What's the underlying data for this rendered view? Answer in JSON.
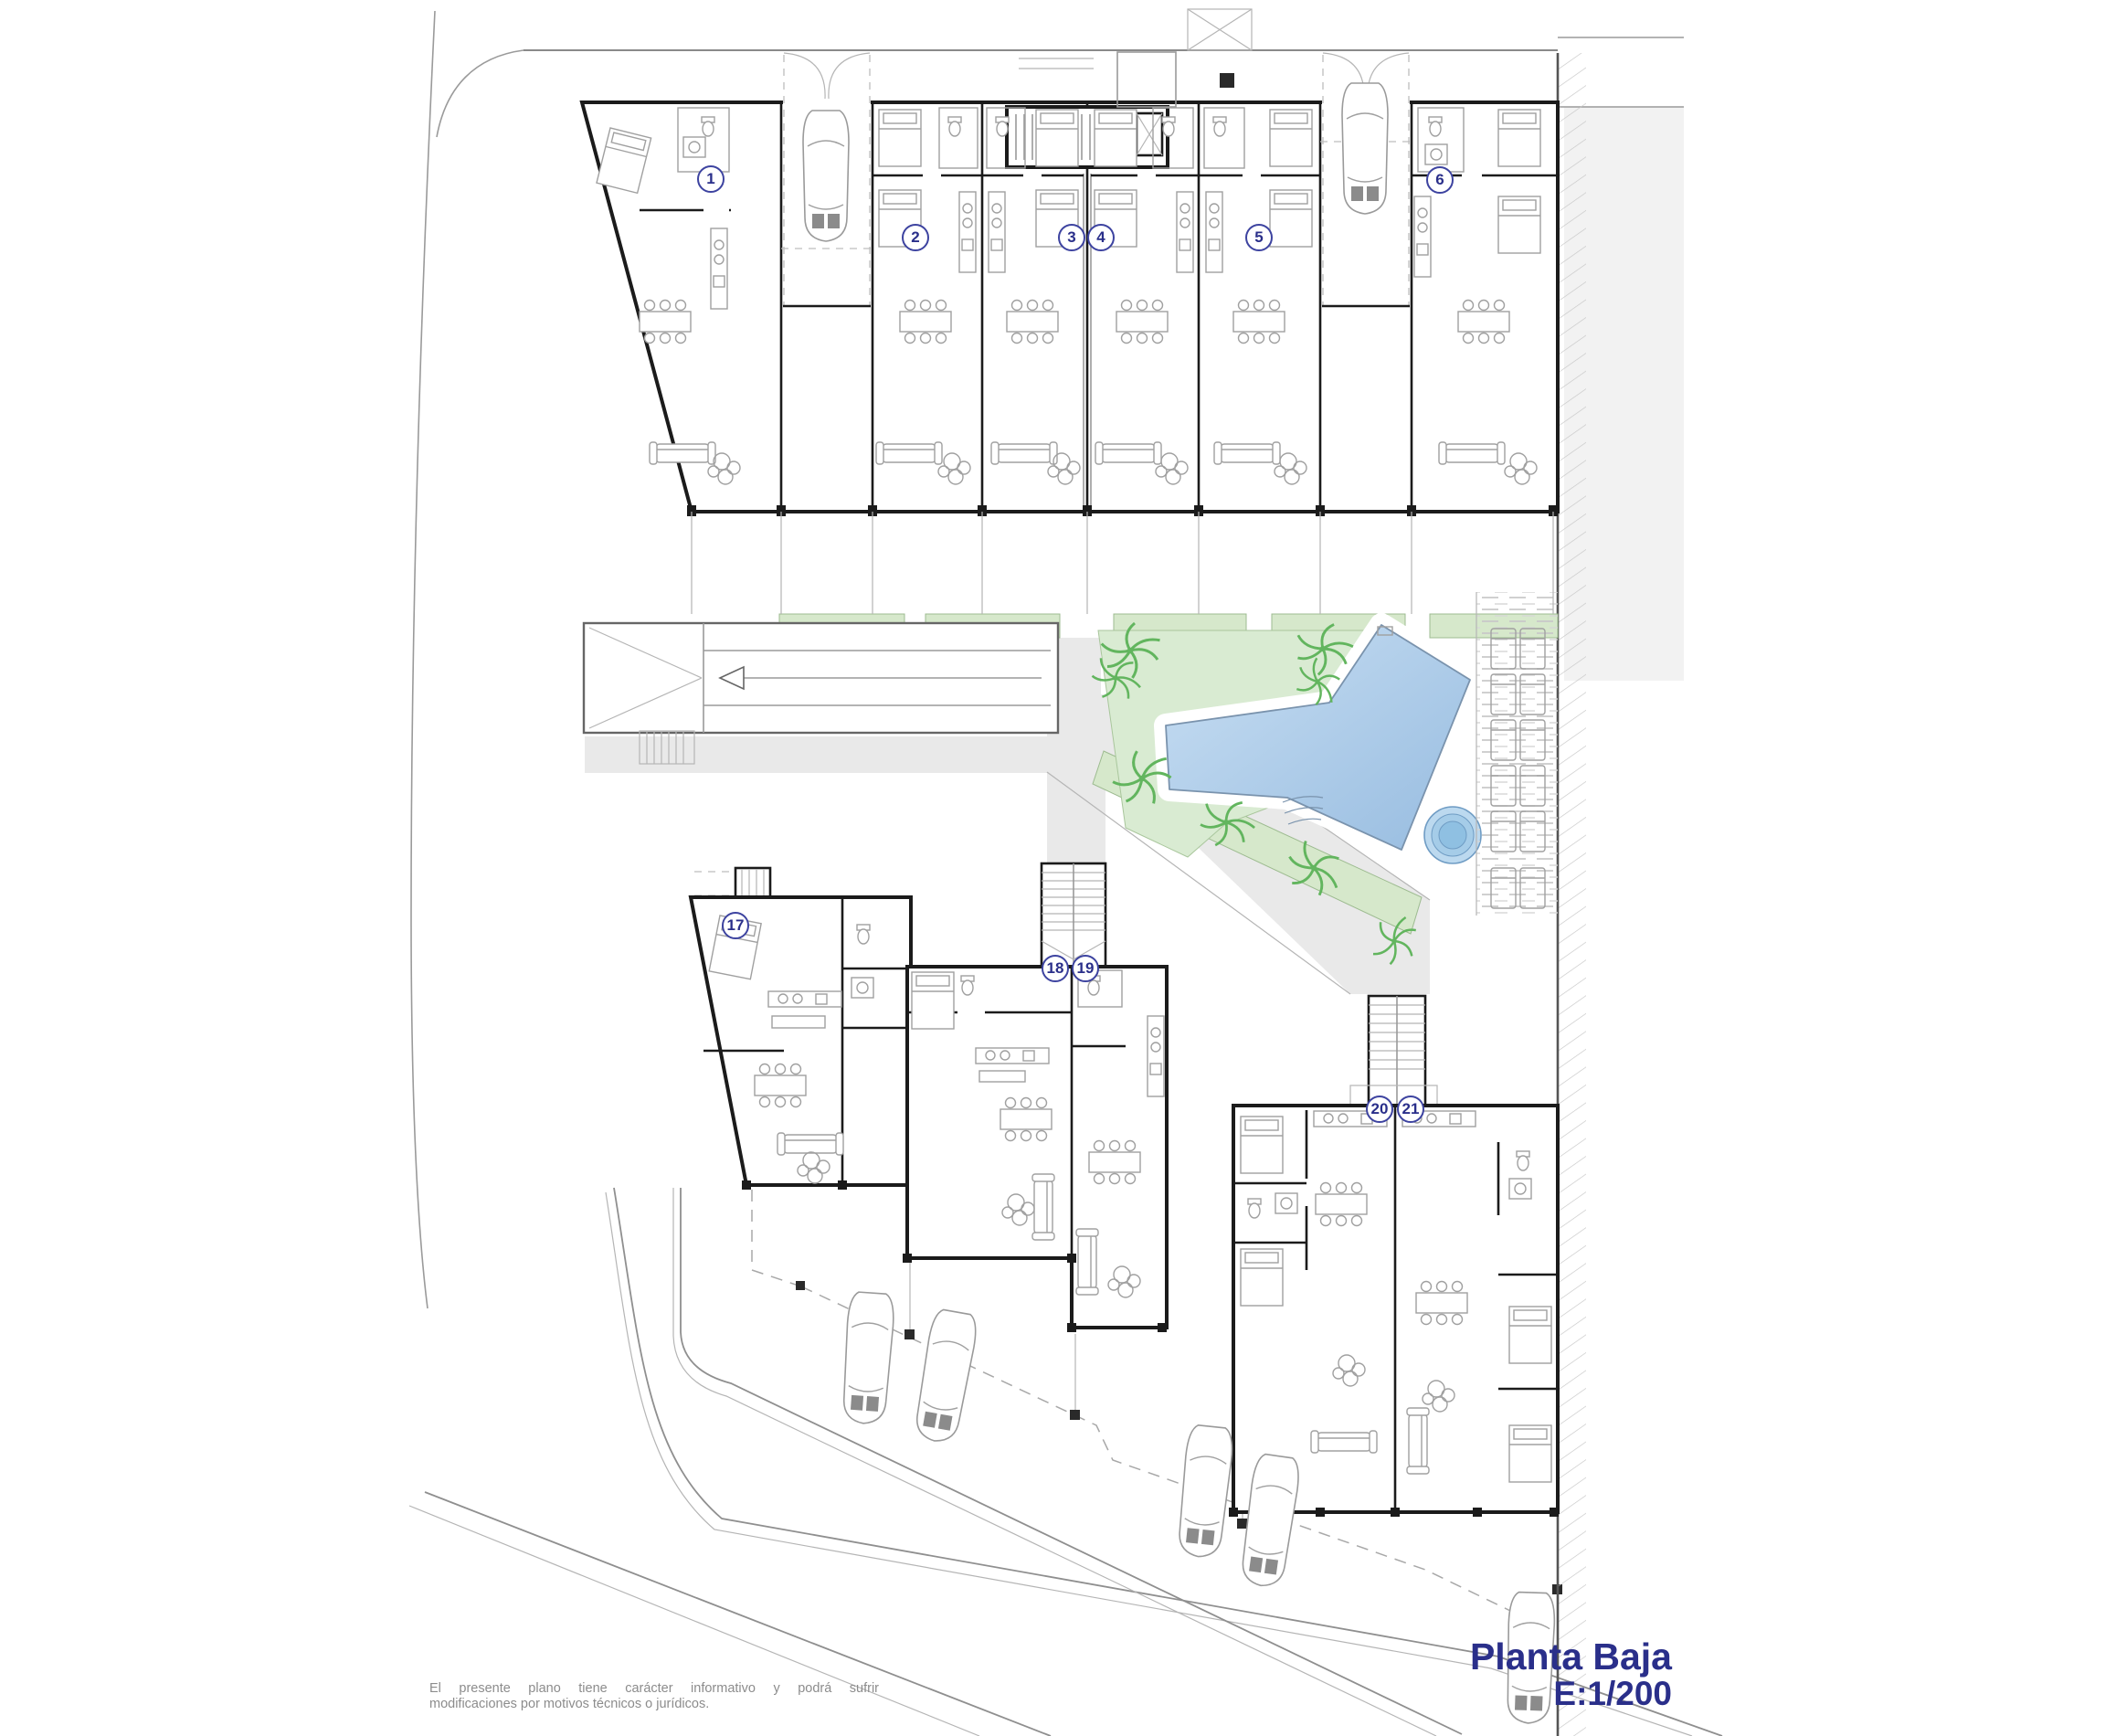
{
  "title_block": {
    "title": "Planta Baja",
    "scale": "E:1/200"
  },
  "disclaimer": {
    "line1": "El presente plano tiene carácter informativo y podrá sufrir",
    "line2": "modificaciones por motivos técnicos o jurídicos."
  },
  "units": [
    "1",
    "2",
    "3",
    "4",
    "5",
    "6",
    "17",
    "18",
    "19",
    "20",
    "21"
  ],
  "icons": {
    "car": "car-plan-symbol",
    "palm": "palm-tree-symbol",
    "pool": "swimming-pool-symbol",
    "spa": "round-spa-symbol",
    "lounger": "sun-lounger-symbol",
    "stairs": "staircase-symbol",
    "ramp_arrow": "garage-ramp-arrow",
    "bed": "double-bed-symbol",
    "dining_table": "table-six-chairs-symbol",
    "sofa": "sofa-symbol"
  },
  "colors": {
    "accent_text": "#2a2f8a",
    "lawn": "#d9ebd2",
    "planter": "#d6e8cb",
    "pool": "#a9c9e8",
    "pool_light": "#c9dff3",
    "spa": "#8fc0e2",
    "paving": "#e9e9e9",
    "wall": "#1b1b1b",
    "palm": "#62b55e",
    "disclaimer_text": "#8c8c8c"
  }
}
